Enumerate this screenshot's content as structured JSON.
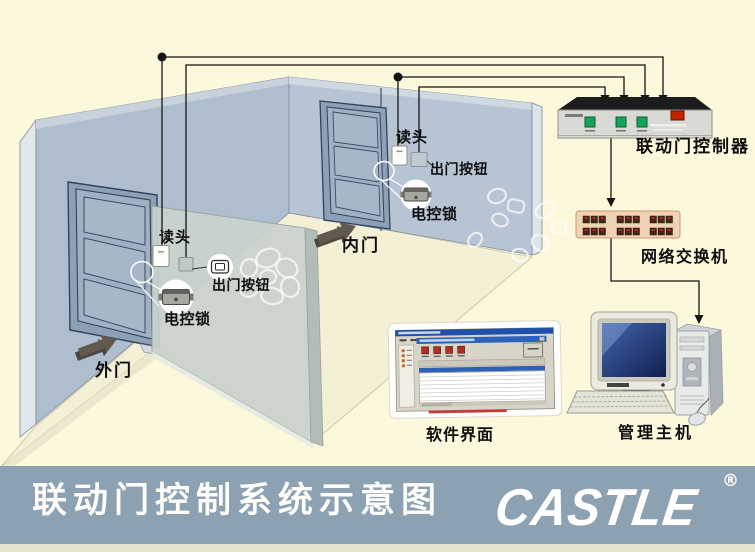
{
  "labels": {
    "outer_reader": "读头",
    "outer_exit_button": "出门按钮",
    "outer_lock": "电控锁",
    "outer_door": "外门",
    "inner_reader": "读头",
    "inner_exit_button": "出门按钮",
    "inner_lock": "电控锁",
    "inner_door": "内门",
    "controller": "联动门控制器",
    "network_switch": "网络交换机",
    "software_ui": "软件界面",
    "management_host": "管理主机"
  },
  "footer": {
    "title": "联动门控制系统示意图",
    "brand": "CASTLE",
    "registered": "®"
  },
  "colors": {
    "background": "#FBF8DC",
    "footer_bar": "#8CA1B1",
    "wall": "#AFBECE",
    "partition": "#C9D2CE",
    "floor": "#F3F0D5",
    "wire": "#141414",
    "controller_button_green": "#17A35A",
    "controller_switch_red": "#C62200",
    "switch_body_tan": "#F0D2B4",
    "screen_blue": "#27418C"
  }
}
